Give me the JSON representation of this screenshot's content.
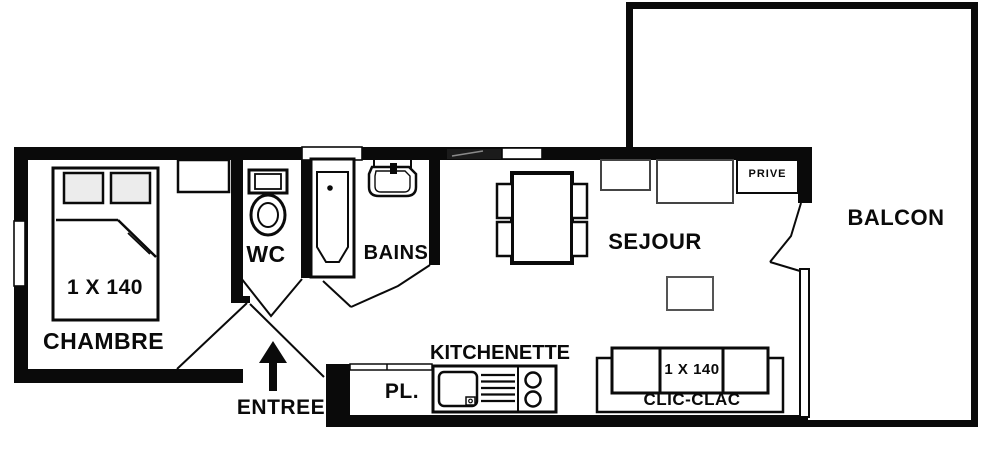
{
  "colors": {
    "wall": "#0a0a0a",
    "background": "#ffffff",
    "pillow_fill": "#ececec",
    "tinted_window": "#1b1b1b"
  },
  "rooms": [
    {
      "name": "chambre",
      "label": "CHAMBRE",
      "bed_label": "1 X 140",
      "furniture": [
        "double-bed",
        "pillows",
        "nightstand",
        "window"
      ]
    },
    {
      "name": "wc",
      "label": "WC",
      "furniture": [
        "toilet"
      ]
    },
    {
      "name": "bains",
      "label": "BAINS",
      "furniture": [
        "bathtub",
        "washbasin",
        "window"
      ]
    },
    {
      "name": "entree",
      "label": "ENTREE",
      "furniture": [
        "entry-arrow",
        "door-swing"
      ]
    },
    {
      "name": "placard",
      "label": "PL."
    },
    {
      "name": "kitchenette",
      "label": "KITCHENETTE",
      "furniture": [
        "kitchen-sink",
        "drainer",
        "hob-2-burners"
      ]
    },
    {
      "name": "sejour",
      "label": "SEJOUR",
      "sofa_label": "CLIC-CLAC",
      "sofa_size_label": "1 X 140",
      "cupboard_label": "PRIVE",
      "furniture": [
        "dining-table",
        "four-chairs",
        "coffee-table",
        "sideboard",
        "prive-cupboard",
        "clic-clac-sofa",
        "window",
        "glass-door"
      ]
    },
    {
      "name": "balcon",
      "label": "BALCON"
    }
  ]
}
